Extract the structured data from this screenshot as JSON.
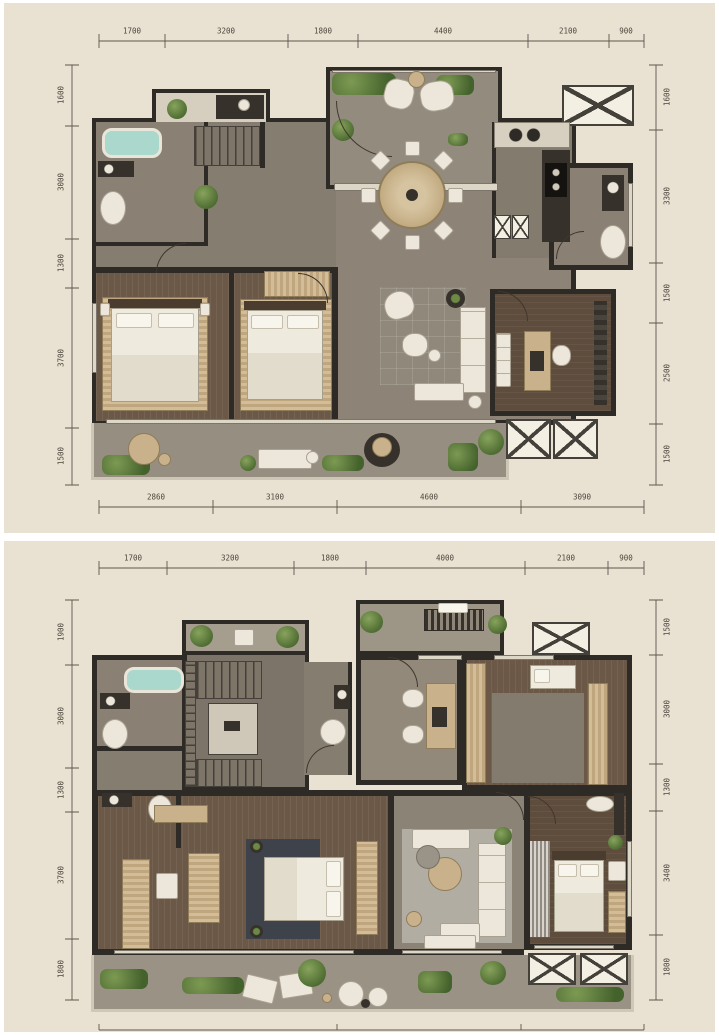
{
  "palette": {
    "paper": "#e9e1d1",
    "wall": "#2e2a25",
    "floor_gray": "#8d8477",
    "floor_wood": "#6b5847",
    "bath_water": "#abd8cc",
    "plant_green": "#4c6a31",
    "furniture_white": "#ece7da",
    "furniture_tan": "#c9b28b",
    "dim_text": "#4d473e"
  },
  "plan1": {
    "dims_top": [
      "1700",
      "3200",
      "1800",
      "4400",
      "2100",
      "900"
    ],
    "dims_bottom": [
      "2860",
      "3100",
      "4600",
      "3090"
    ],
    "dims_left": [
      "1600",
      "3000",
      "1300",
      "3700",
      "1500"
    ],
    "dims_right": [
      "1600",
      "3300",
      "1500",
      "2500",
      "1500"
    ]
  },
  "plan2": {
    "dims_top": [
      "1700",
      "3200",
      "1800",
      "4000",
      "2100",
      "900"
    ],
    "dims_left": [
      "1900",
      "3000",
      "1300",
      "3700",
      "1800"
    ],
    "dims_right": [
      "1500",
      "3000",
      "1300",
      "3400",
      "1800"
    ]
  }
}
